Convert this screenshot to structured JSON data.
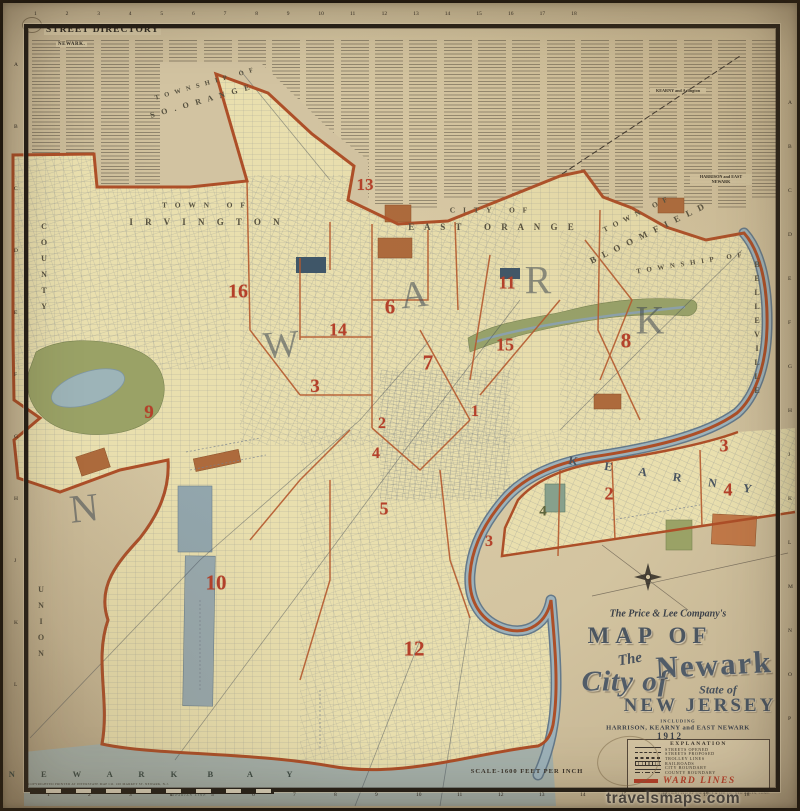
{
  "colors": {
    "paper": "#d3c4a1",
    "city_fill": "#e9dfae",
    "boundary_orange": "#ad4f28",
    "ward_red": "#b5402a",
    "water": "#93a8b2",
    "bay": "#a6b2ac",
    "park_green": "#9aa266",
    "cemetery_sienna": "#ad6a3c"
  },
  "frame": {
    "top_numbers": [
      "1",
      "2",
      "3",
      "4",
      "5",
      "6",
      "7",
      "8",
      "9",
      "10",
      "11",
      "12",
      "13",
      "14",
      "15",
      "16",
      "17",
      "18"
    ],
    "bottom_numbers": [
      "1",
      "2",
      "3",
      "4",
      "5",
      "6",
      "7",
      "8",
      "9",
      "10",
      "11",
      "12",
      "13",
      "14",
      "15",
      "16",
      "17",
      "18"
    ],
    "left_letters": [
      "A",
      "B",
      "C",
      "D",
      "E",
      "F",
      "G",
      "H",
      "J",
      "K",
      "L"
    ],
    "right_letters": [
      "A",
      "B",
      "C",
      "D",
      "E",
      "F",
      "G",
      "H",
      "J",
      "K",
      "L",
      "M",
      "N",
      "O",
      "P"
    ]
  },
  "directory": {
    "title": "STREET DIRECTORY",
    "newark_header": "NEWARK.",
    "kearny_header": "KEARNY and Arlington",
    "harrison_header": "HARRISON and EAST NEWARK"
  },
  "municipality_labels": [
    {
      "text": "T O W N S H I P   O F",
      "x": 205,
      "y": 84,
      "rot": -16,
      "size": 6.5,
      "ls": 2
    },
    {
      "text": "S O . O R A N G E",
      "x": 201,
      "y": 101,
      "rot": -16,
      "size": 8,
      "ls": 2.5
    },
    {
      "text": "T O W N   O F",
      "x": 205,
      "y": 205,
      "rot": 0,
      "size": 7.5,
      "ls": 3
    },
    {
      "text": "I R V I N G T O N",
      "x": 207,
      "y": 222,
      "rot": 0,
      "size": 9,
      "ls": 5
    },
    {
      "text": "C I T Y   O F",
      "x": 490,
      "y": 210,
      "rot": 0,
      "size": 7.5,
      "ls": 3
    },
    {
      "text": "E A S T   O R A N G E",
      "x": 493,
      "y": 227,
      "rot": 0,
      "size": 9,
      "ls": 4
    },
    {
      "text": "T O W N   O F",
      "x": 636,
      "y": 214,
      "rot": -26,
      "size": 7.5,
      "ls": 2
    },
    {
      "text": "B L O O M F I E L D",
      "x": 648,
      "y": 233,
      "rot": -26,
      "size": 9,
      "ls": 2.5
    },
    {
      "text": "T O W N S H I P   O F",
      "x": 690,
      "y": 263,
      "rot": -9,
      "size": 7,
      "ls": 2
    },
    {
      "text": "BELLEVILLE",
      "x": 757,
      "y": 330,
      "rot": 0,
      "size": 8,
      "ls": 5,
      "stack": true
    },
    {
      "text": "COUNTY",
      "x": 44,
      "y": 270,
      "rot": 0,
      "size": 8,
      "ls": 7,
      "stack": true
    },
    {
      "text": "UNION",
      "x": 41,
      "y": 625,
      "rot": 0,
      "size": 8,
      "ls": 7,
      "stack": true
    },
    {
      "text": "N E W A R K",
      "x": 99,
      "y": 774,
      "rot": 0,
      "size": 8.5,
      "ls": 12,
      "color": "#3c4b46"
    },
    {
      "text": "B A Y",
      "x": 258,
      "y": 774,
      "rot": 0,
      "size": 8.5,
      "ls": 16,
      "color": "#3c4b46"
    },
    {
      "text": "K E A R N Y",
      "x": 666,
      "y": 476,
      "rot": 9,
      "size": 12,
      "ls": 12,
      "color": "#4a5560"
    }
  ],
  "big_letters": [
    {
      "ch": "N",
      "x": 84,
      "y": 508,
      "size": 40,
      "rot": -6
    },
    {
      "ch": "W",
      "x": 281,
      "y": 345,
      "size": 38,
      "rot": -4
    },
    {
      "ch": "A",
      "x": 414,
      "y": 295,
      "size": 38,
      "rot": -6
    },
    {
      "ch": "R",
      "x": 538,
      "y": 280,
      "size": 40,
      "rot": 0
    },
    {
      "ch": "K",
      "x": 650,
      "y": 320,
      "size": 40,
      "rot": 0
    }
  ],
  "ward_numbers": [
    {
      "n": "13",
      "x": 365,
      "y": 185,
      "size": 17
    },
    {
      "n": "16",
      "x": 238,
      "y": 292,
      "size": 20
    },
    {
      "n": "14",
      "x": 338,
      "y": 330,
      "size": 18
    },
    {
      "n": "6",
      "x": 390,
      "y": 307,
      "size": 21
    },
    {
      "n": "7",
      "x": 428,
      "y": 363,
      "size": 21
    },
    {
      "n": "11",
      "x": 507,
      "y": 283,
      "size": 18
    },
    {
      "n": "15",
      "x": 505,
      "y": 345,
      "size": 18
    },
    {
      "n": "8",
      "x": 626,
      "y": 341,
      "size": 21
    },
    {
      "n": "3",
      "x": 315,
      "y": 387,
      "size": 19
    },
    {
      "n": "9",
      "x": 149,
      "y": 413,
      "size": 19
    },
    {
      "n": "2",
      "x": 382,
      "y": 424,
      "size": 16
    },
    {
      "n": "4",
      "x": 376,
      "y": 454,
      "size": 16
    },
    {
      "n": "1",
      "x": 475,
      "y": 412,
      "size": 16
    },
    {
      "n": "5",
      "x": 384,
      "y": 509,
      "size": 18
    },
    {
      "n": "10",
      "x": 216,
      "y": 583,
      "size": 21
    },
    {
      "n": "12",
      "x": 414,
      "y": 649,
      "size": 21
    },
    {
      "n": "3",
      "x": 724,
      "y": 446,
      "size": 18
    },
    {
      "n": "4",
      "x": 728,
      "y": 490,
      "size": 18
    },
    {
      "n": "2",
      "x": 609,
      "y": 494,
      "size": 18
    },
    {
      "n": "3",
      "x": 489,
      "y": 542,
      "size": 16
    },
    {
      "n": "4",
      "x": 543,
      "y": 512,
      "size": 15,
      "color": "#5e663d"
    }
  ],
  "title_block": {
    "company": "The Price & Lee Company's",
    "map_of": "MAP OF",
    "the": "The",
    "city_of": "City of",
    "newark": "Newark",
    "state_of": "State of",
    "new_jersey": "NEW JERSEY",
    "including": "INCLUDING",
    "municipalities": "HARRISON, KEARNY and EAST NEWARK",
    "year": "1912"
  },
  "legend": {
    "title": "EXPLANATION",
    "items": [
      {
        "label": "STREETS OPENED",
        "style": "solid"
      },
      {
        "label": "STREETS PROPOSED",
        "style": "dashed"
      },
      {
        "label": "TROLLEY LINES",
        "style": "trolley"
      },
      {
        "label": "RAILROADS",
        "style": "railroad"
      },
      {
        "label": "CITY BOUNDARY",
        "style": "cityline"
      },
      {
        "label": "COUNTY BOUNDARY",
        "style": "countyline"
      }
    ],
    "ward_label": "WARD LINES",
    "copyright": "COPYRIGHT 1912 BY THE PRICE & LEE CO., NEW HAVEN, CONN."
  },
  "scale_note": "SCALE-1600 FEET PER INCH",
  "imprint": "COPYRIGHTED PRINTED AT INTERSTATE MAP CO. 100 MARKET ST. NEWARK, N.J.",
  "bay_note": "RIPARIAN LINE",
  "watermark": "travelsmaps.com"
}
